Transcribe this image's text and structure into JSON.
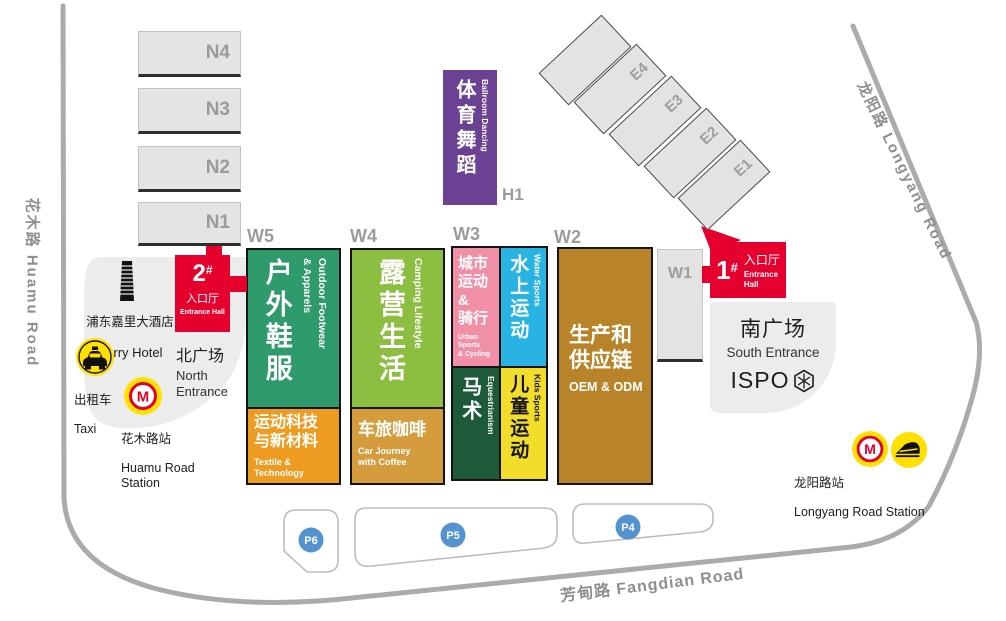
{
  "roads": {
    "huamu": "花木路  Huamu Road",
    "longyang": "龙阳路  Longyang Road",
    "fangdian": "芳甸路 Fangdian Road"
  },
  "halls": {
    "n4": "N4",
    "n3": "N3",
    "n2": "N2",
    "n1": "N1",
    "e4": "E4",
    "e3": "E3",
    "e2": "E2",
    "e1": "E1",
    "w1": "W1",
    "h1": "H1"
  },
  "sections": {
    "w5": "W5",
    "w4": "W4",
    "w3": "W3",
    "w2": "W2"
  },
  "pav": {
    "outdoor": {
      "zh": "户外鞋服",
      "en": "Outdoor Footwear\n& Apparels"
    },
    "textile": {
      "zh": "运动科技\n与新材料",
      "en": "Textile &\nTechnology"
    },
    "camping": {
      "zh": "露营生活",
      "en": "Camping Lifestyle"
    },
    "car": {
      "zh": "车旅咖啡",
      "en": "Car Journey\nwith Coffee"
    },
    "urban": {
      "zh": "城市\n运动\n&\n骑行",
      "en": "Urban Sports\n& Cycling"
    },
    "water": {
      "zh": "水上运动",
      "en": "Water Sports"
    },
    "equestrian": {
      "zh": "马术",
      "en": "Equestrianism"
    },
    "kids": {
      "zh": "儿童运动",
      "en": "Kids Sports"
    },
    "oem": {
      "zh": "生产和\n供应链",
      "en": "OEM & ODM"
    },
    "ballroom": {
      "zh": "体育舞蹈",
      "en": "Ballroom Dancing"
    }
  },
  "entrances": {
    "one": {
      "num": "1",
      "sup": "#",
      "zh": "入口厅",
      "en": "Entrance\nHall"
    },
    "two": {
      "num": "2",
      "sup": "#",
      "zh": "入口厅",
      "en": "Entrance Hall"
    },
    "north": {
      "zh": "北广场",
      "en": "North\nEntrance"
    },
    "south": {
      "zh": "南广场",
      "en": "South Entrance",
      "brand": "ISPO"
    }
  },
  "landmarks": {
    "kerry": {
      "zh": "浦东嘉里大酒店",
      "en": "Kerry Hotel"
    },
    "taxi": {
      "zh": "出租车",
      "en": "Taxi"
    },
    "huamu_station": {
      "zh": "花木路站",
      "en": "Huamu Road\nStation"
    },
    "longyang_station": {
      "zh": "龙阳路站",
      "en": "Longyang Road Station"
    }
  },
  "parking": {
    "p6": "P6",
    "p5": "P5",
    "p4": "P4"
  },
  "colors": {
    "entrance_red": "#e5002e",
    "outdoor_green": "#2f9a6b",
    "textile_orange": "#ee9b21",
    "camping_green": "#8cbf41",
    "car_tan": "#d49c3c",
    "urban_pink": "#f08fa6",
    "water_blue": "#29b3e3",
    "equestrian_green": "#1d5a39",
    "kids_yellow": "#f3dd2b",
    "oem_brown": "#b98429",
    "ballroom_purple": "#6a4193",
    "parking_blue": "#5493d0",
    "metro_yellow": "#ffe000",
    "metro_red": "#e4002b",
    "hall_gray": "#e4e4e4",
    "road_gray": "#ababab"
  }
}
